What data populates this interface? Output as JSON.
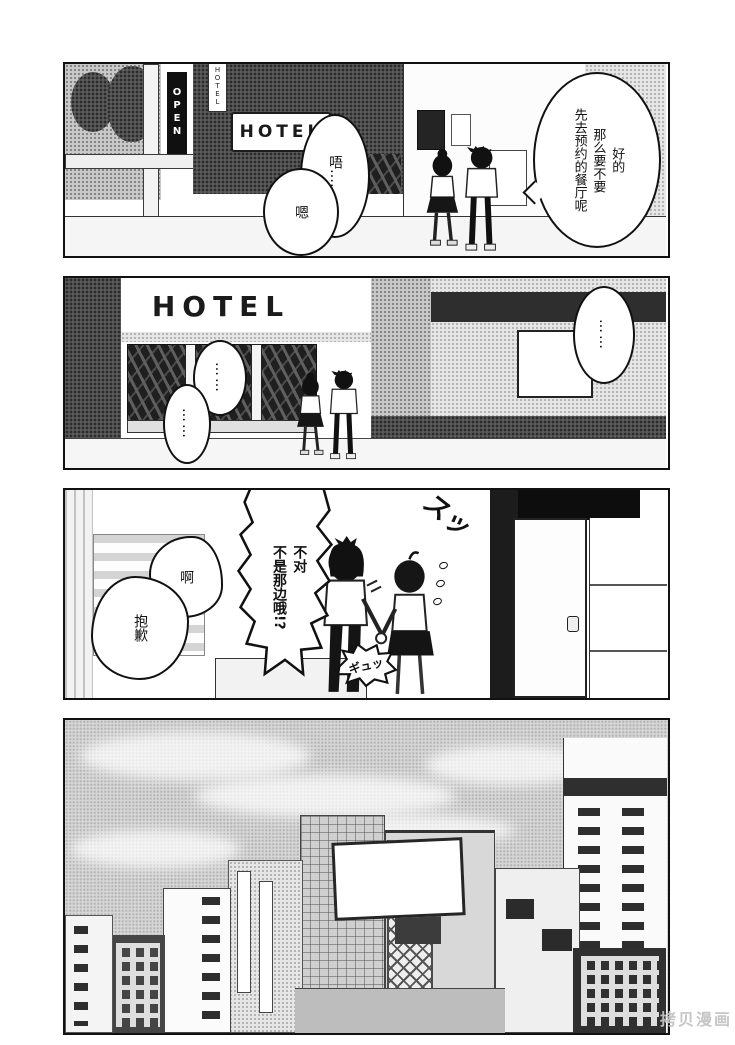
{
  "colors": {
    "ink": "#111111",
    "paper": "#ffffff",
    "watermark_gray": "#c3c3c3"
  },
  "watermark": "拷贝漫画",
  "p1": {
    "open_sign": "OPEN",
    "hotel_sign_vertical": "HOTEL",
    "hotel_sign": "HOTEL",
    "bubble_reply": "好的\n那么要不要\n先去预约的餐厅呢",
    "bubble_hmm": "唔……",
    "bubble_mm": "嗯"
  },
  "p2": {
    "hotel_sign": "HOTEL",
    "bubble_dots_right": "……",
    "bubble_dots_upper": "……",
    "bubble_dots_lower": "……"
  },
  "p3": {
    "bubble_correction": "不对\n不是那边哦!?",
    "bubble_ah": "啊",
    "bubble_sorry": "抱歉",
    "sfx_slip": "スッ",
    "sfx_grip": "ギュッ"
  }
}
